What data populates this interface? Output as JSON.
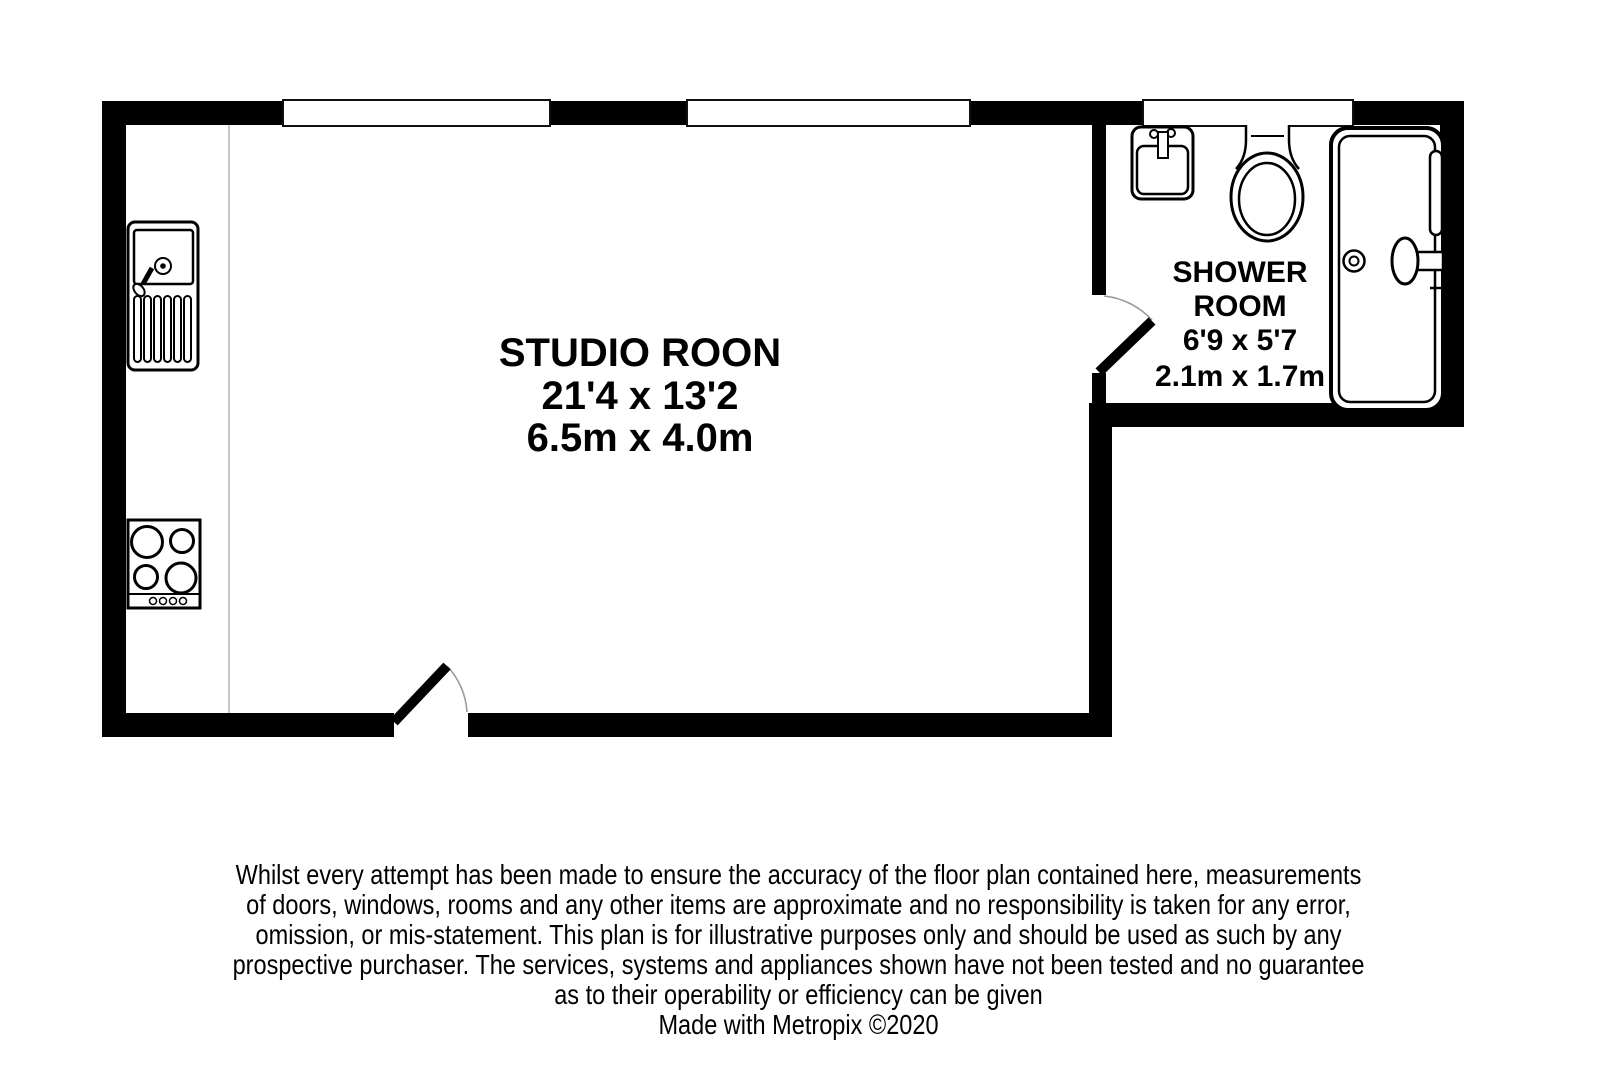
{
  "plan": {
    "studio": {
      "name": "STUDIO ROON",
      "size_imperial": "21'4 x 13'2",
      "size_metric": "6.5m x 4.0m"
    },
    "shower_room": {
      "name_line1": "SHOWER",
      "name_line2": "ROOM",
      "size_imperial": "6'9 x 5'7",
      "size_metric": "2.1m x 1.7m"
    },
    "fixtures": [
      "kitchen-sink",
      "hob",
      "bathroom-sink",
      "toilet",
      "bathtub"
    ],
    "window_count": 3,
    "door_count": 2,
    "colors": {
      "wall": "#000000",
      "background": "#ffffff",
      "door_arc": "#9a9a9a",
      "counter_line": "#b3b3b3"
    }
  },
  "footer": {
    "disclaimer_lines": [
      "Whilst every attempt has been made to ensure the accuracy of the floor plan contained here, measurements",
      "of doors, windows, rooms and any other items are approximate and no responsibility is taken for any error,",
      "omission, or mis-statement. This plan is for illustrative purposes only and should be used as such by any",
      "prospective purchaser. The services, systems and appliances shown have not been tested and no guarantee",
      "as to their operability or efficiency can be given"
    ],
    "credit": "Made with Metropix ©2020"
  }
}
